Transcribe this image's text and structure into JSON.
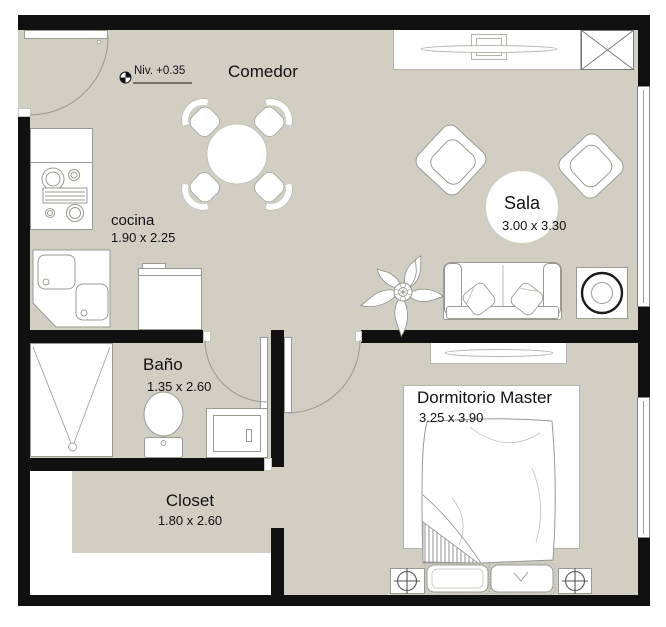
{
  "plan": {
    "type": "apartment-floor-plan",
    "level_annotation": "Niv. +0.35",
    "rooms": [
      {
        "id": "comedor",
        "label": "Comedor",
        "dims": ""
      },
      {
        "id": "cocina",
        "label": "cocina",
        "dims": "1.90 x 2.25"
      },
      {
        "id": "sala",
        "label": "Sala",
        "dims": "3.00 x 3.30"
      },
      {
        "id": "bano",
        "label": "Baño",
        "dims": "1.35 x 2.60"
      },
      {
        "id": "closet",
        "label": "Closet",
        "dims": "1.80 x 2.60"
      },
      {
        "id": "dormitorio",
        "label": "Dormitorio Master",
        "dims": "3.25 x 3.90"
      }
    ],
    "colors": {
      "floor": "#d1cfc4",
      "wall": "#101010",
      "furniture_outline": "#9a9a92",
      "text": "#111111",
      "background": "#ffffff"
    }
  }
}
